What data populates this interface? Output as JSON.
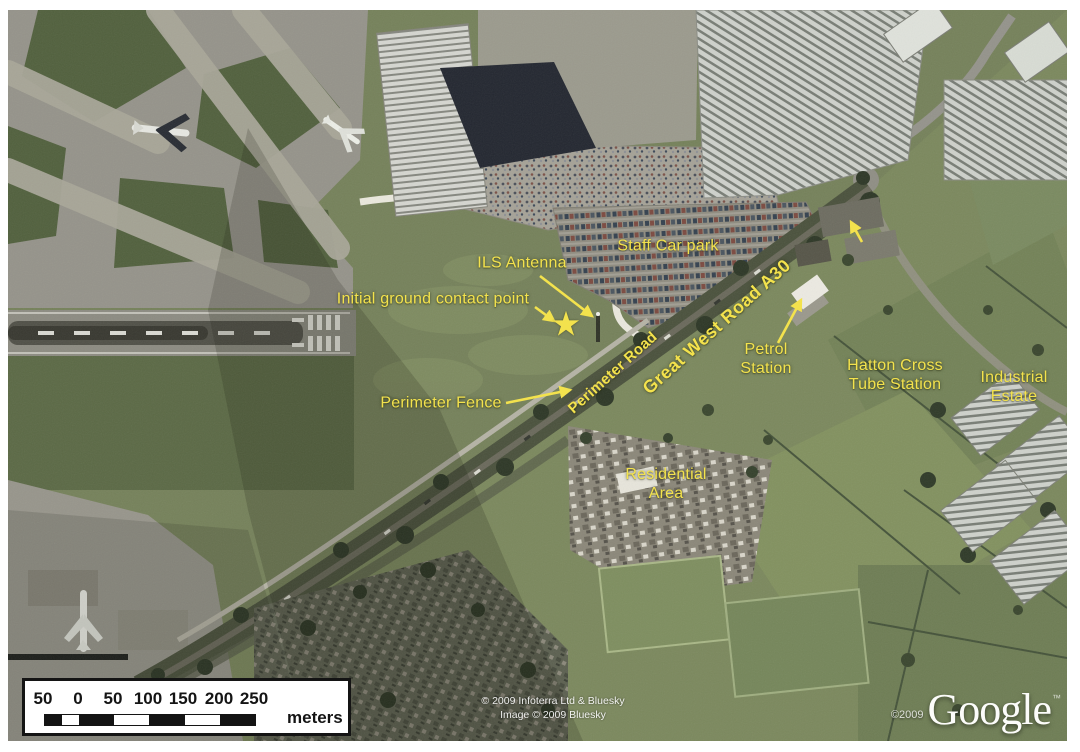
{
  "map": {
    "labels": [
      {
        "id": "staff-car-park",
        "text": "Staff Car park"
      },
      {
        "id": "ils-antenna",
        "text": "ILS Antenna"
      },
      {
        "id": "initial-ground-contact-point",
        "text": "Initial ground contact point"
      },
      {
        "id": "perimeter-fence",
        "text": "Perimeter Fence"
      },
      {
        "id": "perimeter-road",
        "text": "Perimeter Road"
      },
      {
        "id": "great-west-road-a30",
        "text": "Great West Road A30"
      },
      {
        "id": "petrol-station",
        "text": "Petrol\nStation"
      },
      {
        "id": "hatton-cross-tube-station",
        "text": "Hatton Cross\nTube Station"
      },
      {
        "id": "industrial-estate",
        "text": "Industrial\nEstate"
      },
      {
        "id": "residential-area",
        "text": "Residential\nArea"
      }
    ],
    "scale_bar": {
      "ticks": [
        "50",
        "0",
        "50",
        "100",
        "150",
        "200",
        "250"
      ],
      "unit": "meters"
    },
    "credits": {
      "line1": "© 2009 Infoterra Ltd & Bluesky",
      "line2": "Image © 2009 Bluesky"
    },
    "google": {
      "copyright": "©2009",
      "logo": "Google",
      "tm": "™"
    },
    "colors": {
      "annotation_yellow": "#f3e24d",
      "scale_bar_text": "#141414",
      "credit_text": "#ffffff"
    }
  }
}
